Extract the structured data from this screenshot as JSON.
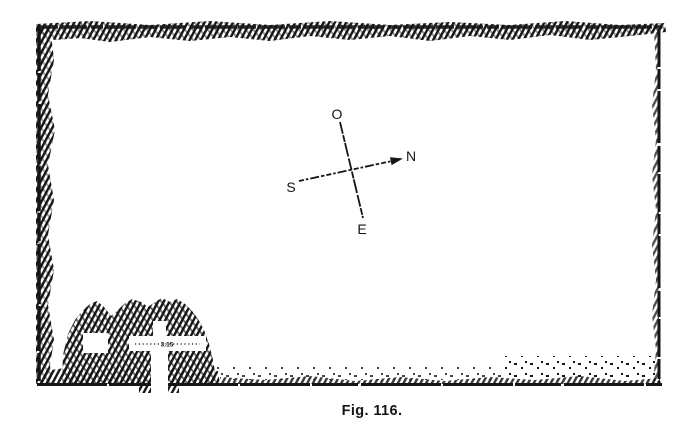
{
  "figure": {
    "caption": "Fig. 116."
  },
  "compass": {
    "top": "O",
    "right": "N",
    "left": "S",
    "bottom": "E"
  },
  "plan": {
    "passage_measurement": "3.15"
  },
  "colors": {
    "ink": "#151515",
    "paper": "#ffffff"
  }
}
